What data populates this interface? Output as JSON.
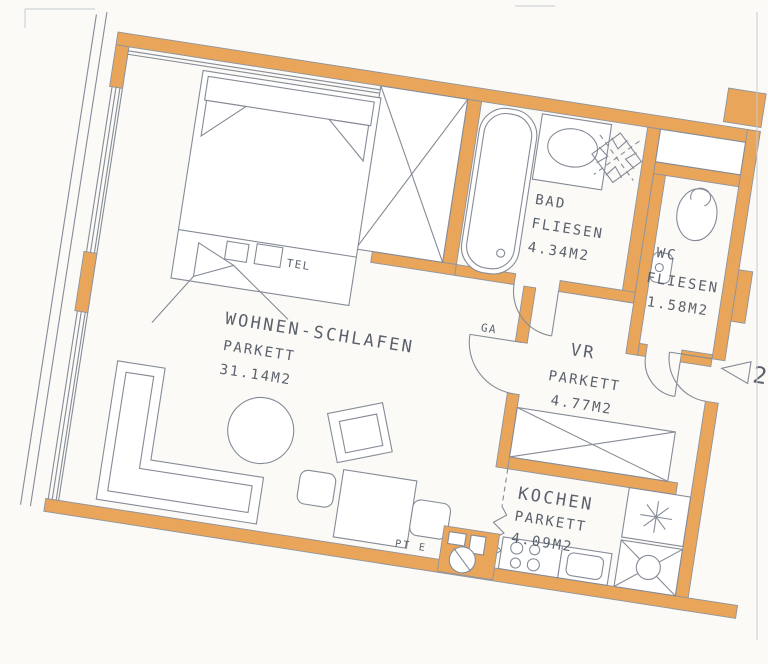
{
  "plan": {
    "rooms": [
      {
        "name": "WOHNEN-SCHLAFEN",
        "floor": "PARKETT",
        "area": "31.14M2"
      },
      {
        "name": "BAD",
        "floor": "FLIESEN",
        "area": "4.34M2"
      },
      {
        "name": "WC",
        "floor": "FLIESEN",
        "area": "1.58M2"
      },
      {
        "name": "VR",
        "floor": "PARKETT",
        "area": "4.77M2"
      },
      {
        "name": "KOCHEN",
        "floor": "PARKETT",
        "area": "4.09M2"
      }
    ],
    "annotations": {
      "telephone_outlet": "TEL",
      "ga": "GA",
      "pt_shaft": "PT E",
      "entrance_number": "23"
    },
    "colors": {
      "wall": "#E9A55A",
      "line": "#858B96",
      "background": "#FBFAF7"
    },
    "symbols": [
      "bed",
      "wardrobe-crossed",
      "bathtub",
      "washbasin",
      "ventilation-fan",
      "toilet",
      "hand-basin",
      "corner-sofa",
      "coffee-table",
      "armchair",
      "dining-table",
      "chair",
      "stove",
      "kitchen-sink",
      "sink-unit",
      "star-symbol",
      "shaft-symbol",
      "door-swing-arc",
      "entrance-marker-triangle",
      "window-glazing",
      "zigzag-break-line"
    ]
  }
}
